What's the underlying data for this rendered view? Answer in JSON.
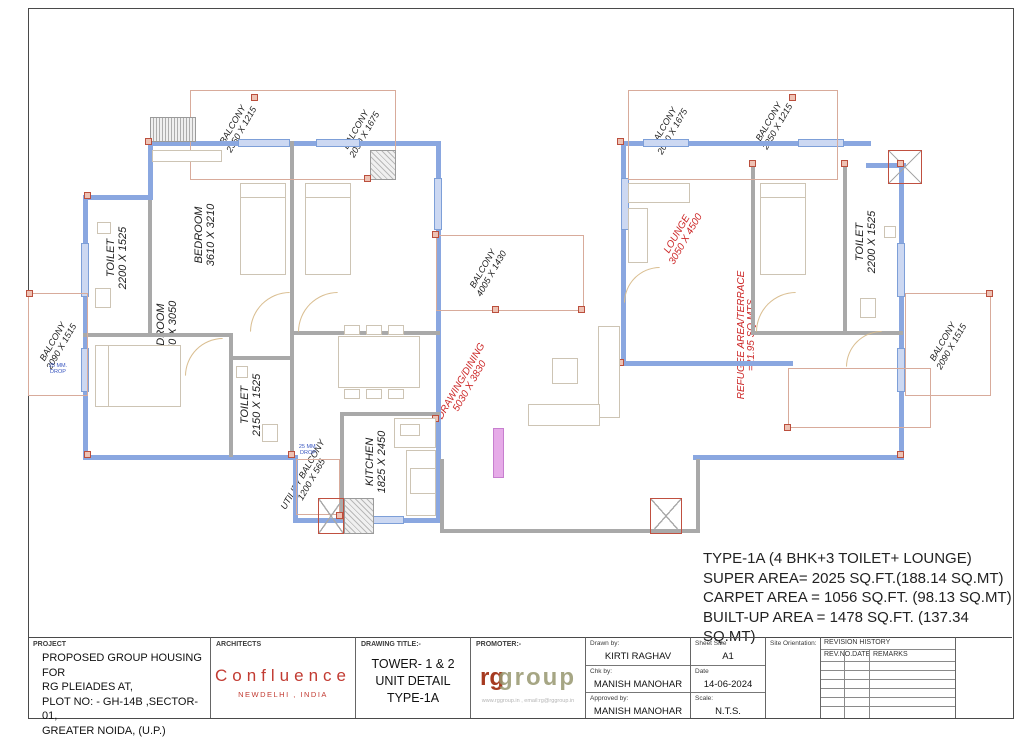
{
  "areas": {
    "lines": [
      "TYPE-1A (4 BHK+3 TOILET+ LOUNGE)",
      "SUPER AREA= 2025 SQ.FT.(188.14 SQ.MT)",
      "CARPET AREA = 1056 SQ.FT. (98.13 SQ.MT)",
      "BUILT-UP AREA = 1478 SQ.FT. (137.34 SQ.MT)"
    ]
  },
  "plan": {
    "rooms": {
      "toilet_tl": {
        "name": "TOILET",
        "dims": "2200 X 1525"
      },
      "bed1": {
        "name": "BEDROOM",
        "dims": "3610 X 3210"
      },
      "bed2": {
        "name": "BEDROOM",
        "dims": "3050 X 3050"
      },
      "bed3": {
        "name": "BEDROOM",
        "dims": "3070 X 3050"
      },
      "toilet_ml": {
        "name": "TOILET",
        "dims": "2150 X 1525"
      },
      "kitchen": {
        "name": "KITCHEN",
        "dims": "1825 X 2450"
      },
      "bed_r": {
        "name": "BEDROOM",
        "dims": "3610 X 3210"
      },
      "toilet_r": {
        "name": "TOILET",
        "dims": "2200 X 1525"
      },
      "lounge": {
        "name": "LOUNGE",
        "dims": "3050 X 4500"
      },
      "drawing_dining": {
        "name": "DRAWING/DINING",
        "dims": "5030 X 3830"
      },
      "refuge": {
        "name": "REFUGEE AREA/TERRACE",
        "dims": "=21.95 SQ.MTS"
      },
      "utility": {
        "name": "UTILITY BALCONY",
        "dims": "1200 X 565"
      }
    },
    "balconies": {
      "tl": {
        "name": "BALCONY",
        "dims": "2350 X 1215"
      },
      "tl2": {
        "name": "BALCONY",
        "dims": "2090 X 1675"
      },
      "center": {
        "name": "BALCONY",
        "dims": "4005 X 1430"
      },
      "tr1": {
        "name": "BALCONY",
        "dims": "2090 X 1675"
      },
      "tr2": {
        "name": "BALCONY",
        "dims": "2350 X 1215"
      },
      "left_edge": {
        "name": "BALCONY",
        "dims": "2090 X 1515"
      },
      "right_edge": {
        "name": "BALCONY",
        "dims": "2090 X 1515"
      }
    },
    "notes": {
      "drop": "25 MM. DROP"
    }
  },
  "titleblock": {
    "project": {
      "label": "PROJECT",
      "lines": [
        "PROPOSED GROUP HOUSING FOR",
        "RG PLEIADES AT,",
        "PLOT NO: - GH-14B ,SECTOR- 01,",
        "GREATER NOIDA, (U.P.)"
      ]
    },
    "architects": {
      "label": "ARCHITECTS",
      "name": "Confluence",
      "sub": "NEWDELHI , INDIA"
    },
    "drawing_title": {
      "label": "DRAWING TITLE:-",
      "lines": [
        "TOWER- 1 & 2",
        "UNIT DETAIL",
        "TYPE-1A"
      ]
    },
    "promoter": {
      "label": "PROMOTER:-",
      "logo_rg": "rg",
      "logo_group": "group",
      "website": "www.rggroup.in , email:rg@rggroup.in"
    },
    "people": {
      "drawn_label": "Drawn by:",
      "drawn": "KIRTI RAGHAV",
      "chk_label": "Chk by:",
      "chk": "MANISH MANOHAR",
      "approved_label": "Approved by:",
      "approved": "MANISH MANOHAR"
    },
    "meta": {
      "sheet_size_label": "Sheet Size",
      "sheet_size": "A1",
      "date_label": "Date",
      "date": "14-06-2024",
      "scale_label": "Scale:",
      "scale": "N.T.S.",
      "orientation_label": "Site Orientation:"
    },
    "revision": {
      "title": "REVISION HISTORY",
      "col1": "REV.NO.DATE",
      "col2": "REMARKS"
    }
  }
}
